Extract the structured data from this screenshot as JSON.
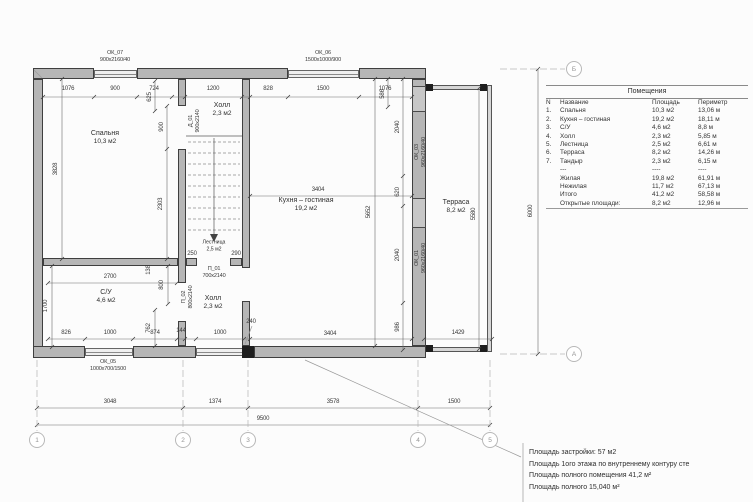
{
  "table": {
    "title": "Помещения",
    "headers": [
      "N",
      "Название",
      "Площадь",
      "Периметр"
    ],
    "rows": [
      [
        "1.",
        "Спальня",
        "10,3 м2",
        "13,06 м"
      ],
      [
        "2.",
        "Кухня – гостиная",
        "19,2 м2",
        "18,11 м"
      ],
      [
        "3.",
        "С/У",
        "4,6 м2",
        "8,8 м"
      ],
      [
        "4.",
        "Холл",
        "2,3 м2",
        "5,85 м"
      ],
      [
        "5.",
        "Лестница",
        "2,5 м2",
        "6,61 м"
      ],
      [
        "6.",
        "Терраса",
        "8,2 м2",
        "14,26 м"
      ],
      [
        "7.",
        "Тандыр",
        "2,3 м2",
        "6,15 м"
      ],
      [
        "",
        "---",
        "----",
        "----"
      ],
      [
        "",
        "Жилая",
        "19,8 м2",
        "61,91 м"
      ],
      [
        "",
        "Нежилая",
        "11,7 м2",
        "67,13 м"
      ],
      [
        "",
        "Итого",
        "41,2 м2",
        "58,58 м"
      ],
      [
        "",
        "Открытые площади:",
        "8,2 м2",
        "12,96 м"
      ]
    ]
  },
  "notes": [
    "Площадь застройки: 57 м2",
    "Площадь 1ого этажа по внутреннему контуру сте",
    "Площадь полного помещения 41,2 м²",
    "Площадь полного 15,040 м²"
  ],
  "plan": {
    "rooms": [
      {
        "name": "Спальня",
        "area": "10,3 м2",
        "x": 105,
        "y": 138
      },
      {
        "name": "Холл",
        "area": "2,3 м2",
        "x": 222,
        "y": 110
      },
      {
        "name": "Кухня – гостиная",
        "area": "19,2 м2",
        "x": 306,
        "y": 205
      },
      {
        "name": "Терраса",
        "area": "8,2 м2",
        "x": 456,
        "y": 207
      },
      {
        "name": "С/У",
        "area": "4,6 м2",
        "x": 106,
        "y": 297
      },
      {
        "name": "Холл",
        "area": "2,3 м2",
        "x": 213,
        "y": 303
      },
      {
        "name": "Лестница",
        "area": "2,5 м2",
        "x": 214,
        "y": 246,
        "sm": 1
      }
    ],
    "openings": [
      {
        "id": "ОК_07",
        "size": "900х2160/40",
        "x": 115,
        "y": 57
      },
      {
        "id": "ОК_06",
        "size": "1500х1000/900",
        "x": 323,
        "y": 57
      },
      {
        "id": "ОК_05",
        "size": "1000х700/1500",
        "x": 108,
        "y": 366
      },
      {
        "id": "ОК_03",
        "size": "960х2160/40",
        "x": 421,
        "y": 152,
        "r": 1
      },
      {
        "id": "ОК_01",
        "size": "960х2160/40",
        "x": 421,
        "y": 258,
        "r": 1
      },
      {
        "id": "Д_01",
        "size": "900х2140",
        "x": 195,
        "y": 121,
        "r": 1
      },
      {
        "id": "П_02",
        "size": "800х2140",
        "x": 188,
        "y": 297,
        "r": 1
      },
      {
        "id": "П_01",
        "size": "700х2140",
        "x": 214,
        "y": 273
      }
    ],
    "dimensions": [
      {
        "t": "1076",
        "x": 68,
        "y": 89
      },
      {
        "t": "900",
        "x": 115,
        "y": 89
      },
      {
        "t": "724",
        "x": 154,
        "y": 89
      },
      {
        "t": "1200",
        "x": 213,
        "y": 89
      },
      {
        "t": "828",
        "x": 268,
        "y": 89
      },
      {
        "t": "1500",
        "x": 323,
        "y": 89
      },
      {
        "t": "1076",
        "x": 385,
        "y": 89
      },
      {
        "t": "625",
        "x": 150,
        "y": 97,
        "r": 1
      },
      {
        "t": "900",
        "x": 162,
        "y": 127,
        "r": 1
      },
      {
        "t": "586",
        "x": 383,
        "y": 94,
        "r": 1
      },
      {
        "t": "3828",
        "x": 56,
        "y": 169,
        "r": 1
      },
      {
        "t": "2303",
        "x": 161,
        "y": 204,
        "r": 1
      },
      {
        "t": "3404",
        "x": 318,
        "y": 190
      },
      {
        "t": "5652",
        "x": 369,
        "y": 212,
        "r": 1
      },
      {
        "t": "2040",
        "x": 398,
        "y": 127,
        "r": 1
      },
      {
        "t": "620",
        "x": 398,
        "y": 192,
        "r": 1
      },
      {
        "t": "2040",
        "x": 398,
        "y": 255,
        "r": 1
      },
      {
        "t": "986",
        "x": 398,
        "y": 327,
        "r": 1
      },
      {
        "t": "5580",
        "x": 474,
        "y": 214,
        "r": 1
      },
      {
        "t": "2700",
        "x": 110,
        "y": 277
      },
      {
        "t": "138",
        "x": 149,
        "y": 270,
        "r": 1
      },
      {
        "t": "1700",
        "x": 46,
        "y": 306,
        "r": 1
      },
      {
        "t": "800",
        "x": 162,
        "y": 285,
        "r": 1
      },
      {
        "t": "762",
        "x": 149,
        "y": 328,
        "r": 1
      },
      {
        "t": "826",
        "x": 66,
        "y": 333
      },
      {
        "t": "1000",
        "x": 110,
        "y": 333
      },
      {
        "t": "874",
        "x": 155,
        "y": 333
      },
      {
        "t": "144",
        "x": 181,
        "y": 331
      },
      {
        "t": "1000",
        "x": 220,
        "y": 333
      },
      {
        "t": "240",
        "x": 251,
        "y": 322
      },
      {
        "t": "3404",
        "x": 330,
        "y": 334
      },
      {
        "t": "1429",
        "x": 458,
        "y": 333
      },
      {
        "t": "250",
        "x": 192,
        "y": 254
      },
      {
        "t": "290",
        "x": 236,
        "y": 254
      },
      {
        "t": "6000",
        "x": 531,
        "y": 211,
        "r": 1
      },
      {
        "t": "3048",
        "x": 110,
        "y": 402
      },
      {
        "t": "1374",
        "x": 215,
        "y": 402
      },
      {
        "t": "3578",
        "x": 333,
        "y": 402
      },
      {
        "t": "1500",
        "x": 454,
        "y": 402
      },
      {
        "t": "9500",
        "x": 263,
        "y": 419
      }
    ],
    "grid": {
      "cols": [
        {
          "t": "1",
          "x": 37
        },
        {
          "t": "2",
          "x": 183
        },
        {
          "t": "3",
          "x": 248
        },
        {
          "t": "4",
          "x": 418
        },
        {
          "t": "5",
          "x": 490
        }
      ],
      "cols_y": 440,
      "rows": [
        {
          "t": "Б",
          "y": 69
        },
        {
          "t": "А",
          "y": 354
        }
      ],
      "rows_x": 574
    },
    "colors": {
      "wall_fill": "#b6b6b6",
      "line": "#6a6a6a",
      "text": "#3a3a3a"
    }
  }
}
